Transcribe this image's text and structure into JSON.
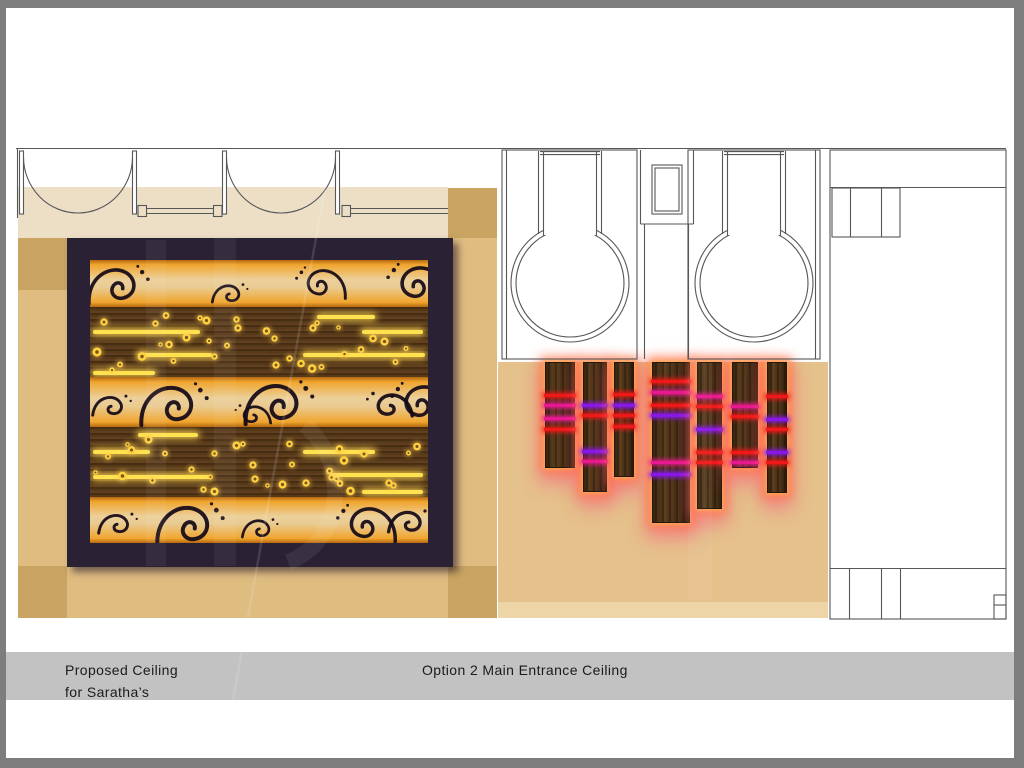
{
  "banner": {
    "line1": "Proposed Ceiling",
    "line2": "for Saratha’s",
    "option": "Option 2 Main Entrance Ceiling"
  },
  "colors": {
    "page": "#ffffff",
    "frame_gray": "#7d7d7d",
    "banner_gray": "#c2c2c2",
    "vestibule_beige": "#ecdfc6",
    "floor_tan": "#dfbc80",
    "column_base_tan": "#c9a462",
    "panel_frame_purple": "#2b2134",
    "gold_band": "#ecd09a",
    "wood_brown": "#4f3316",
    "light_bar_yellow": "#ffe24f",
    "slat_glow_orange": "#ff7a4d",
    "slat_glow_pink": "#ff4f8c",
    "plan_line": "#57575a"
  },
  "ceiling_panel": {
    "bands": [
      {
        "kind": "gold",
        "h": 47
      },
      {
        "kind": "wood",
        "h": 70
      },
      {
        "kind": "gold",
        "h": 50
      },
      {
        "kind": "wood",
        "h": 70
      },
      {
        "kind": "gold",
        "h": 46
      }
    ],
    "bars": {
      "1": [
        [
          227,
          8,
          58
        ],
        [
          3,
          23,
          107
        ],
        [
          272,
          23,
          61
        ],
        [
          48,
          46,
          74
        ],
        [
          213,
          46,
          122
        ],
        [
          3,
          64,
          62
        ]
      ],
      "3": [
        [
          48,
          6,
          60
        ],
        [
          3,
          23,
          57
        ],
        [
          213,
          23,
          72
        ],
        [
          3,
          48,
          117
        ],
        [
          240,
          46,
          93
        ],
        [
          272,
          63,
          61
        ]
      ]
    },
    "dots_seed": 11,
    "dots_per_band": 34,
    "flourishes": {
      "0": [
        {
          "v": "A",
          "x": -4,
          "y": 2,
          "s": 0.72,
          "flip": false
        },
        {
          "v": "B",
          "x": 120,
          "y": 18,
          "s": 0.55,
          "flip": false
        },
        {
          "v": "A",
          "x": 198,
          "y": 4,
          "s": 0.6,
          "flip": true
        },
        {
          "v": "A",
          "x": 288,
          "y": 0,
          "s": 0.72,
          "flip": true
        }
      ],
      "2": [
        {
          "v": "B",
          "x": 0,
          "y": 12,
          "s": 0.6,
          "flip": false
        },
        {
          "v": "A",
          "x": 48,
          "y": 2,
          "s": 0.8,
          "flip": false
        },
        {
          "v": "B",
          "x": 128,
          "y": 22,
          "s": 0.55,
          "flip": true
        },
        {
          "v": "A",
          "x": 152,
          "y": 0,
          "s": 0.82,
          "flip": false
        },
        {
          "v": "B",
          "x": 255,
          "y": 8,
          "s": 0.7,
          "flip": true
        },
        {
          "v": "A",
          "x": 292,
          "y": 2,
          "s": 0.72,
          "flip": true
        }
      ],
      "4": [
        {
          "v": "B",
          "x": 6,
          "y": 10,
          "s": 0.6,
          "flip": false
        },
        {
          "v": "A",
          "x": 64,
          "y": 2,
          "s": 0.8,
          "flip": false
        },
        {
          "v": "B",
          "x": 150,
          "y": 16,
          "s": 0.55,
          "flip": false
        },
        {
          "v": "A",
          "x": 238,
          "y": 4,
          "s": 0.7,
          "flip": true
        },
        {
          "v": "B",
          "x": 296,
          "y": 6,
          "s": 0.65,
          "flip": false
        }
      ]
    }
  },
  "entrance_ceiling": {
    "top": 362,
    "stripe_colors": {
      "R": "#f01818",
      "M": "#e81890",
      "P": "#8818e8"
    },
    "slats": [
      {
        "x": 545,
        "w": 30,
        "bottom": 468,
        "stripes": [
          [
            31,
            "R"
          ],
          [
            41,
            "M"
          ],
          [
            54,
            "M"
          ],
          [
            65,
            "R"
          ]
        ]
      },
      {
        "x": 583,
        "w": 24,
        "bottom": 492,
        "stripes": [
          [
            41,
            "P"
          ],
          [
            51,
            "R"
          ],
          [
            87,
            "P"
          ],
          [
            97,
            "M"
          ]
        ]
      },
      {
        "x": 614,
        "w": 20,
        "bottom": 477,
        "stripes": [
          [
            30,
            "R"
          ],
          [
            41,
            "P"
          ],
          [
            51,
            "R"
          ],
          [
            62,
            "R"
          ]
        ]
      },
      {
        "x": 652,
        "w": 38,
        "bottom": 523,
        "stripes": [
          [
            17,
            "R"
          ],
          [
            28,
            "M"
          ],
          [
            41,
            "R"
          ],
          [
            51,
            "P"
          ],
          [
            98,
            "M"
          ],
          [
            110,
            "P"
          ]
        ]
      },
      {
        "x": 697,
        "w": 25,
        "bottom": 509,
        "stripes": [
          [
            32,
            "M"
          ],
          [
            42,
            "R"
          ],
          [
            65,
            "P"
          ],
          [
            88,
            "R"
          ],
          [
            98,
            "R"
          ]
        ]
      },
      {
        "x": 732,
        "w": 26,
        "bottom": 468,
        "stripes": [
          [
            42,
            "M"
          ],
          [
            52,
            "R"
          ],
          [
            88,
            "R"
          ],
          [
            98,
            "M"
          ]
        ]
      },
      {
        "x": 767,
        "w": 20,
        "bottom": 493,
        "stripes": [
          [
            32,
            "R"
          ],
          [
            55,
            "P"
          ],
          [
            65,
            "R"
          ],
          [
            88,
            "P"
          ],
          [
            98,
            "R"
          ]
        ]
      }
    ]
  }
}
